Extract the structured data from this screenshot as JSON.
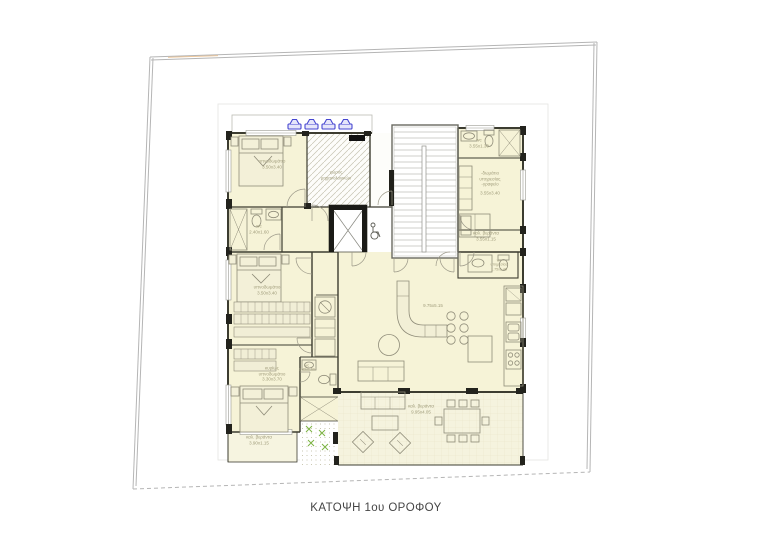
{
  "caption": "ΚΑΤΟΨΗ 1ου ΟΡΟΦΟΥ",
  "labels": {
    "bedroom1": {
      "name": "υπνοδωμάτιο",
      "dims": "3.50x3.40"
    },
    "mechanical": {
      "line1": "χώρος",
      "line2": "μηχανολογικών"
    },
    "wc_top": {
      "name": "wc",
      "dims": "3.55x1.30"
    },
    "service_room": {
      "line1": "-δωμάτιο",
      "line2": "υπηρεσίας",
      "line3": "-γραφείο",
      "dims": "3.55x3.40"
    },
    "veranda_right": {
      "name": "καλ. βεράντα",
      "dims": "3.55x1.15"
    },
    "wc_service": {
      "name": "wc",
      "line2": "υπηρεσίας",
      "dims": "1.75x1.40"
    },
    "wc_left": {
      "name": "wc",
      "dims": "2.40x1.60"
    },
    "bedroom2": {
      "name": "υπνοδωμάτιο",
      "dims": "3.50x3.40"
    },
    "master_bedroom": {
      "line1": "κυρίως",
      "line2": "υπνοδωμάτιο",
      "dims": "3.30x3.70"
    },
    "wc_mid": {
      "name": "wc",
      "dims": "2.45x1.60"
    },
    "living": {
      "dims": "9.75x5.15"
    },
    "veranda_main": {
      "name": "καλ. βεράντα",
      "dims": "9.95x4.05"
    },
    "veranda_left": {
      "name": "καλ. βεράντα",
      "dims": "3.90x1.15"
    }
  },
  "icons": {
    "solar_panel": "solar-panel-icon",
    "wheelchair": "wheelchair-icon",
    "elevator": "elevator-x-icon",
    "staircase": "staircase"
  },
  "counts": {
    "solar_panels": 4
  },
  "colors": {
    "room_fill": "#f6f3d7",
    "veranda_fill": "#f5f3de",
    "wall": "#3c3c30",
    "wall_block": "#23231d",
    "solar_blue": "#4646d0",
    "planter_green": "#7cb342",
    "boundary": "#b5b5b5",
    "label_text": "#a19d7c",
    "caption_text": "#454545"
  }
}
